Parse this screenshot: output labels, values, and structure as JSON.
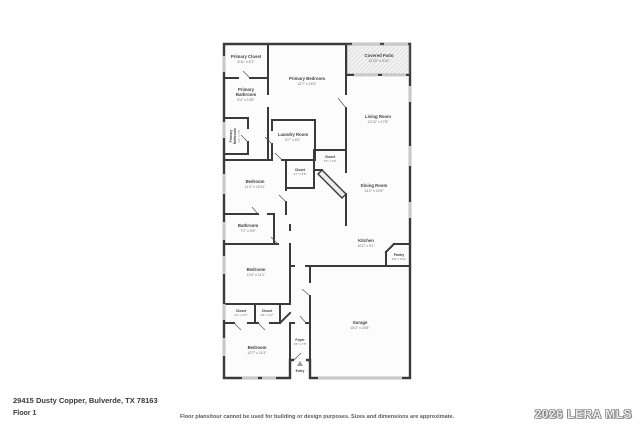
{
  "page": {
    "address": "29415 Dusty Copper, Bulverde, TX 78163",
    "floor_label": "Floor 1",
    "disclaimer": "Floor plans/tour cannot be used for building or design purposes. Sizes and dimensions are approximate.",
    "watermark": "2026 LERA MLS"
  },
  "floorplan": {
    "rooms": {
      "primary_closet": {
        "line1": "Primary Closet",
        "dims": "6'11\" x 6'1\""
      },
      "primary_bathroom": {
        "line1": "Primary",
        "line2": "Bathroom",
        "dims": "9'4\" x 14'5\""
      },
      "primary_bathroom_2": {
        "line1": "Primary",
        "line2": "Bathroom",
        "dims": "3'1\" x 7'5\""
      },
      "primary_bedroom": {
        "line1": "Primary Bedroom",
        "dims": "12'7\" x 16'3\""
      },
      "covered_patio": {
        "line1": "Covered Patio",
        "dims": "12'10\" x 5'10\""
      },
      "living_room": {
        "line1": "Living Room",
        "dims": "12'10\" x 17'8\""
      },
      "laundry_room": {
        "line1": "Laundry Room",
        "dims": "6'7\" x 6'1\""
      },
      "closet_hall": {
        "line1": "Closet",
        "dims": "4'7\" x 6'5\""
      },
      "closet_small": {
        "line1": "Closet",
        "dims": "7'3\" x 3'3\""
      },
      "bedroom_2": {
        "line1": "Bedroom",
        "dims": "11'4\" x 10'11\""
      },
      "dining_room": {
        "line1": "Dining Room",
        "dims": "14'2\" x 10'9\""
      },
      "bathroom": {
        "line1": "Bathroom",
        "dims": "7'1\" x 5'5\""
      },
      "bedroom_3": {
        "line1": "Bedroom",
        "dims": "11'6\" x 11'2\""
      },
      "kitchen": {
        "line1": "Kitchen",
        "dims": "10'2\" x 9'1\""
      },
      "pantry": {
        "line1": "Pantry",
        "dims": "3'9\" x 3'11\""
      },
      "closet_left": {
        "line1": "Closet",
        "dims": "4'1\" x 2'7\""
      },
      "closet_right": {
        "line1": "Closet",
        "dims": "3'6\" x 2'7\""
      },
      "bedroom_4": {
        "line1": "Bedroom",
        "dims": "10'7\" x 11'4\""
      },
      "foyer": {
        "line1": "Foyer",
        "dims": "4'6\" x 7'5\""
      },
      "garage": {
        "line1": "Garage",
        "dims": "18'2\" x 20'8\""
      }
    },
    "entry": {
      "label": "Entry"
    }
  }
}
